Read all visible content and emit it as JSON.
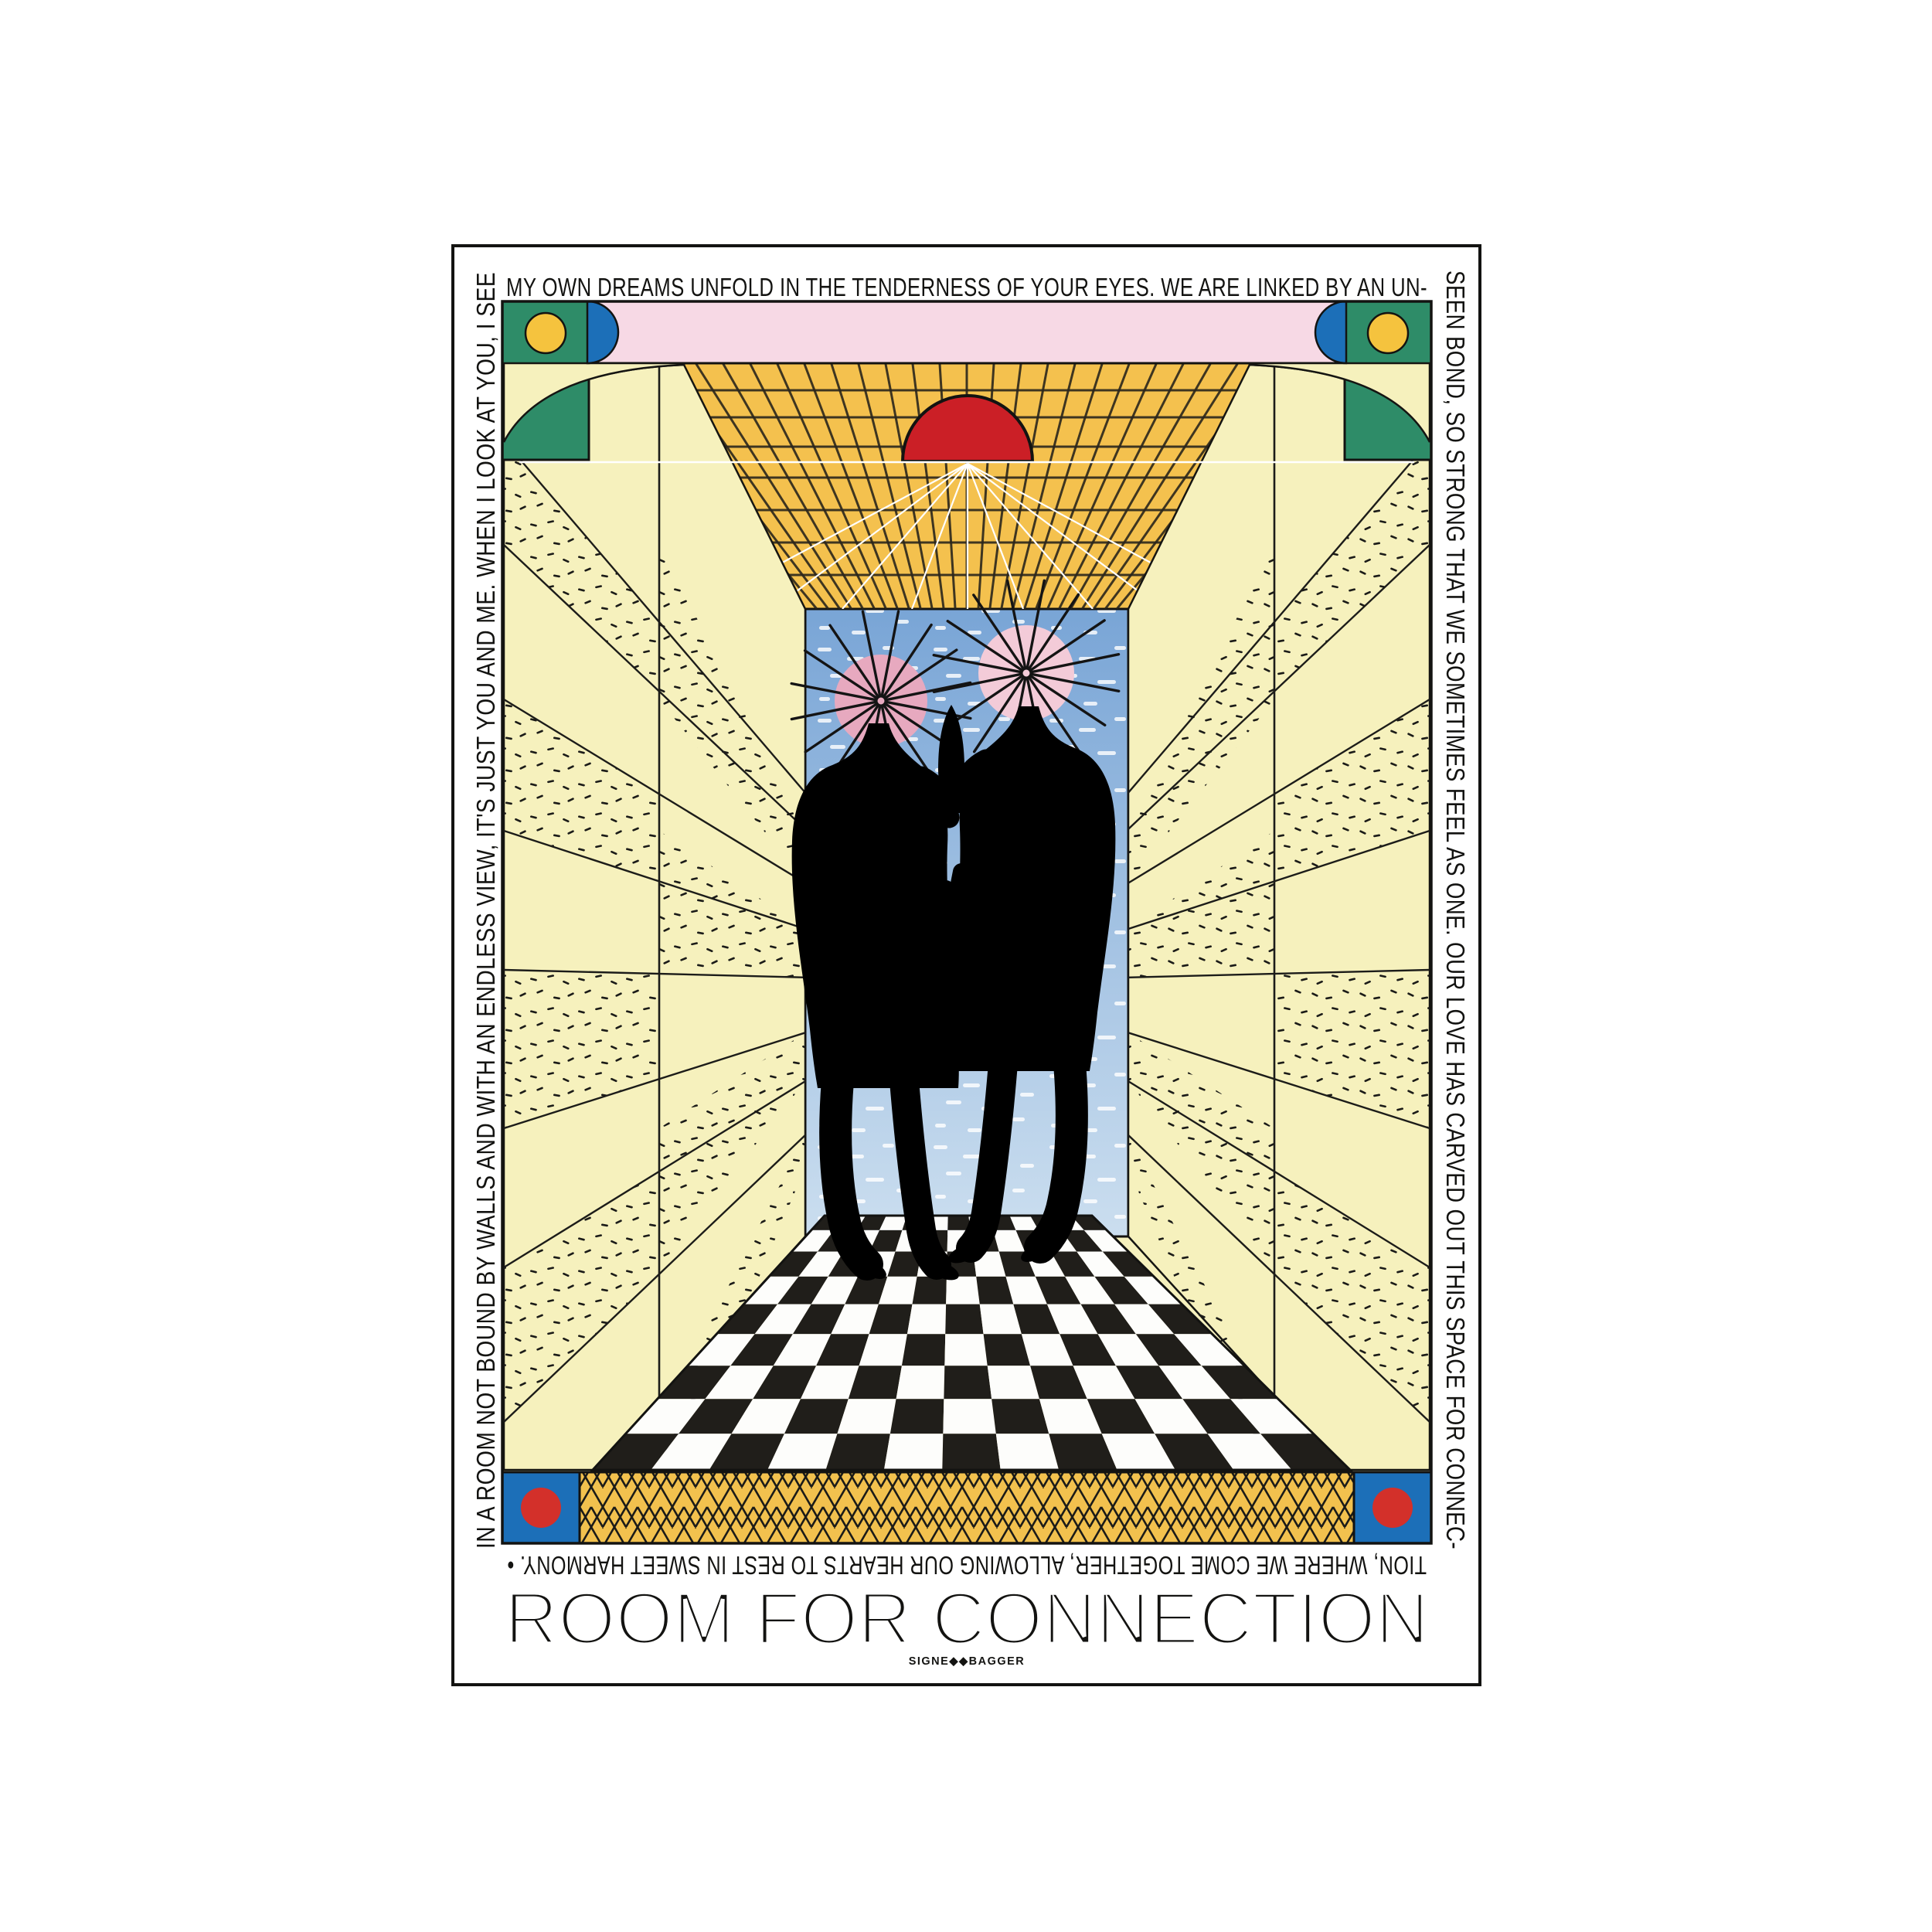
{
  "poster": {
    "title": "ROOM FOR CONNECTION",
    "credit": "SIGNE◆◆BAGGER",
    "border_text": {
      "top": "MY OWN DREAMS UNFOLD IN THE TENDERNESS OF YOUR EYES. WE ARE LINKED BY AN UN-",
      "right": "SEEN BOND, SO STRONG THAT WE SOMETIMES FEEL AS ONE. OUR LOVE HAS CARVED OUT THIS SPACE FOR CONNEC-",
      "bottom": "TION, WHERE WE COME TOGETHER, ALLOWING OUR HEARTS TO REST IN SWEET HARMONY. •",
      "left": "IN A ROOM NOT BOUND BY WALLS AND WITH AN ENDLESS VIEW, IT'S JUST YOU AND ME. WHEN I LOOK AT YOU, I SEE"
    },
    "colors": {
      "ink": "#131311",
      "wall": "#F6F1BD",
      "ceiling": "#F4C14E",
      "sky_top": "#79A5D6",
      "sky_bottom": "#CBDEEF",
      "pink_band": "#F7D9E5",
      "green": "#2E8C68",
      "blue": "#1C6FB8",
      "yellow_dot": "#F5C33E",
      "red": "#CB1F26",
      "gold_band": "#F2C14E",
      "head_left": "#E7A9BF",
      "head_right": "#F3CBD8",
      "checker_dark": "#201E1A",
      "checker_light": "#FDFDFB"
    }
  }
}
